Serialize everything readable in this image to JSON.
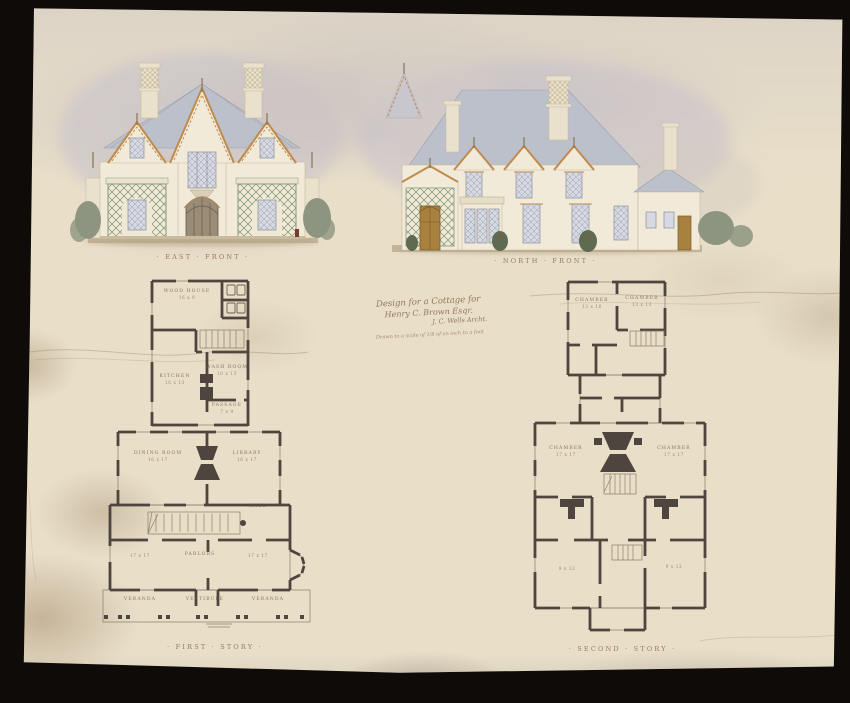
{
  "palette": {
    "backdrop": "#0e0b09",
    "paper": "#e9dfc9",
    "ink": "#4e453f",
    "label-brown": "#8d7355",
    "bargeboard-tan": "#c08a4d",
    "lattice-green": "#7d926d",
    "roof-gray": "#bcc0ca",
    "wall-cream": "#f1ead8",
    "foliage": "#8d9580",
    "sky-wash": "#c7c2cb"
  },
  "elevations": {
    "east_front": {
      "caption": "· EAST · FRONT ·"
    },
    "north_front": {
      "caption": "· NORTH · FRONT ·"
    }
  },
  "inscription": {
    "line1": "Design for a Cottage for",
    "line2": "Henry C. Brown Esqr.",
    "line3": "J. C. Wells Archt.",
    "line4": "Drawn to a scale of 1/8 of an inch to a foot"
  },
  "service_wing": {
    "wood_house": {
      "name": "WOOD HOUSE",
      "dim": "16 x 9"
    },
    "kitchen": {
      "name": "KITCHEN",
      "dim": "16 x 13"
    },
    "wash_room": {
      "name": "WASH ROOM",
      "dim": "10 x 13"
    },
    "passage": {
      "name": "PASSAGE",
      "dim": "7 x 9"
    }
  },
  "first_story": {
    "caption": "· FIRST · STORY ·",
    "dining_room": {
      "name": "DINING ROOM",
      "dim": "16 x 17"
    },
    "library": {
      "name": "LIBRARY",
      "dim": "16 x 17"
    },
    "hall": {
      "name": "HALL"
    },
    "parlors": {
      "name": "PARLORS",
      "dim_left": "17 x 17",
      "dim_right": "17 x 17"
    },
    "veranda_left": "VERANDA",
    "vestibule": "VESTIBULE",
    "veranda_right": "VERANDA"
  },
  "second_story": {
    "caption": "· SECOND · STORY ·",
    "chamber_upper_left": {
      "name": "CHAMBER",
      "dim": "13 x 16"
    },
    "chamber_upper_right": {
      "name": "CHAMBER",
      "dim": "13 x 13"
    },
    "chamber_left": {
      "name": "CHAMBER",
      "dim": "17 x 17"
    },
    "chamber_right": {
      "name": "CHAMBER",
      "dim": "17 x 17"
    },
    "bed_small_left": {
      "dim": "9 x 12"
    },
    "bed_small_right": {
      "dim": "9 x 12"
    }
  }
}
